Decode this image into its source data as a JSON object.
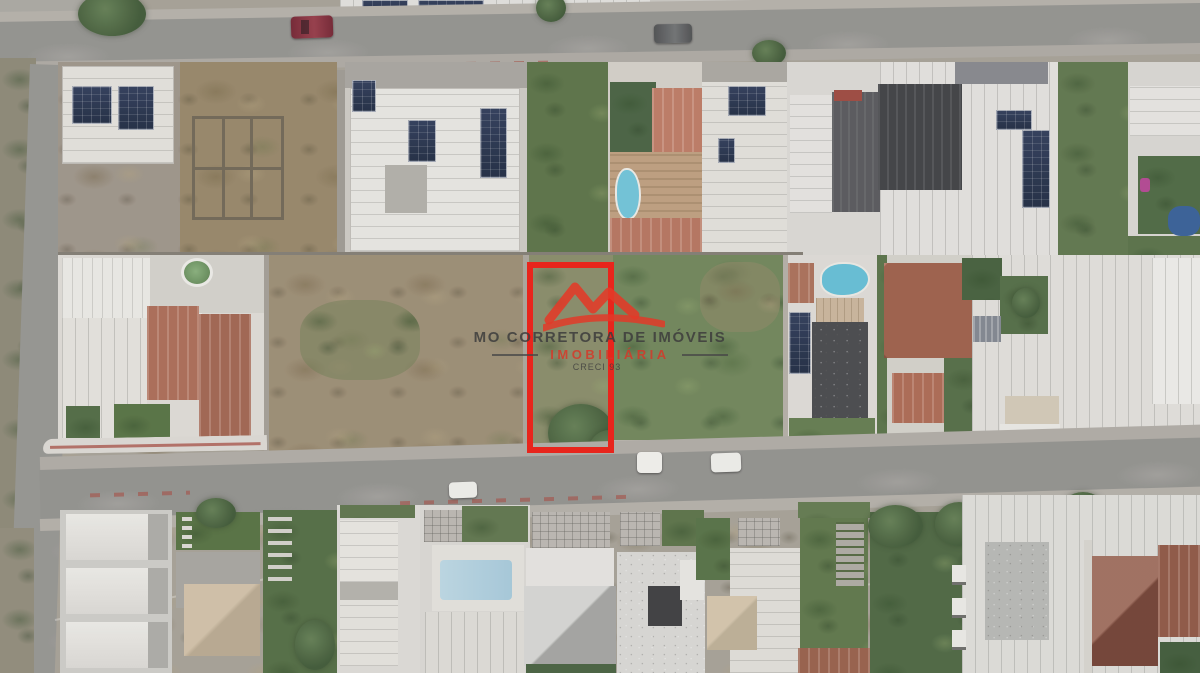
{
  "meta": {
    "kind": "aerial-drone-photo",
    "subject": "residential neighborhood with highlighted vacant lot for sale",
    "width_px": 1200,
    "height_px": 673
  },
  "watermark": {
    "brand_line": "MO CORRETORA DE IMÓVEIS",
    "subtitle": "IMOBILIÁRIA",
    "license": "CRECI 93",
    "text_color": "#3d3d3d",
    "accent_color": "#d63829",
    "logo": "red-mountain-swoosh"
  },
  "highlight": {
    "shape": "rectangle-outline",
    "color": "#e8251c",
    "meaning": "featured vacant lot boundary"
  },
  "palette": {
    "asphalt": "#8f8e8a",
    "sidewalk": "#aca79f",
    "grass_green": "#5d7a41",
    "dirt_tan": "#9a8668",
    "roof_white": "#e2e0db",
    "roof_charcoal": "#3e3f43",
    "roof_terracotta": "#a85a42",
    "roof_beige": "#c9b697",
    "pool_cyan": "#53bdd9",
    "pool_dark_blue": "#2e5ea0",
    "pool_green": "#6f9e62",
    "solar_panel": "#263352",
    "red_kerb": "#b5564f"
  }
}
